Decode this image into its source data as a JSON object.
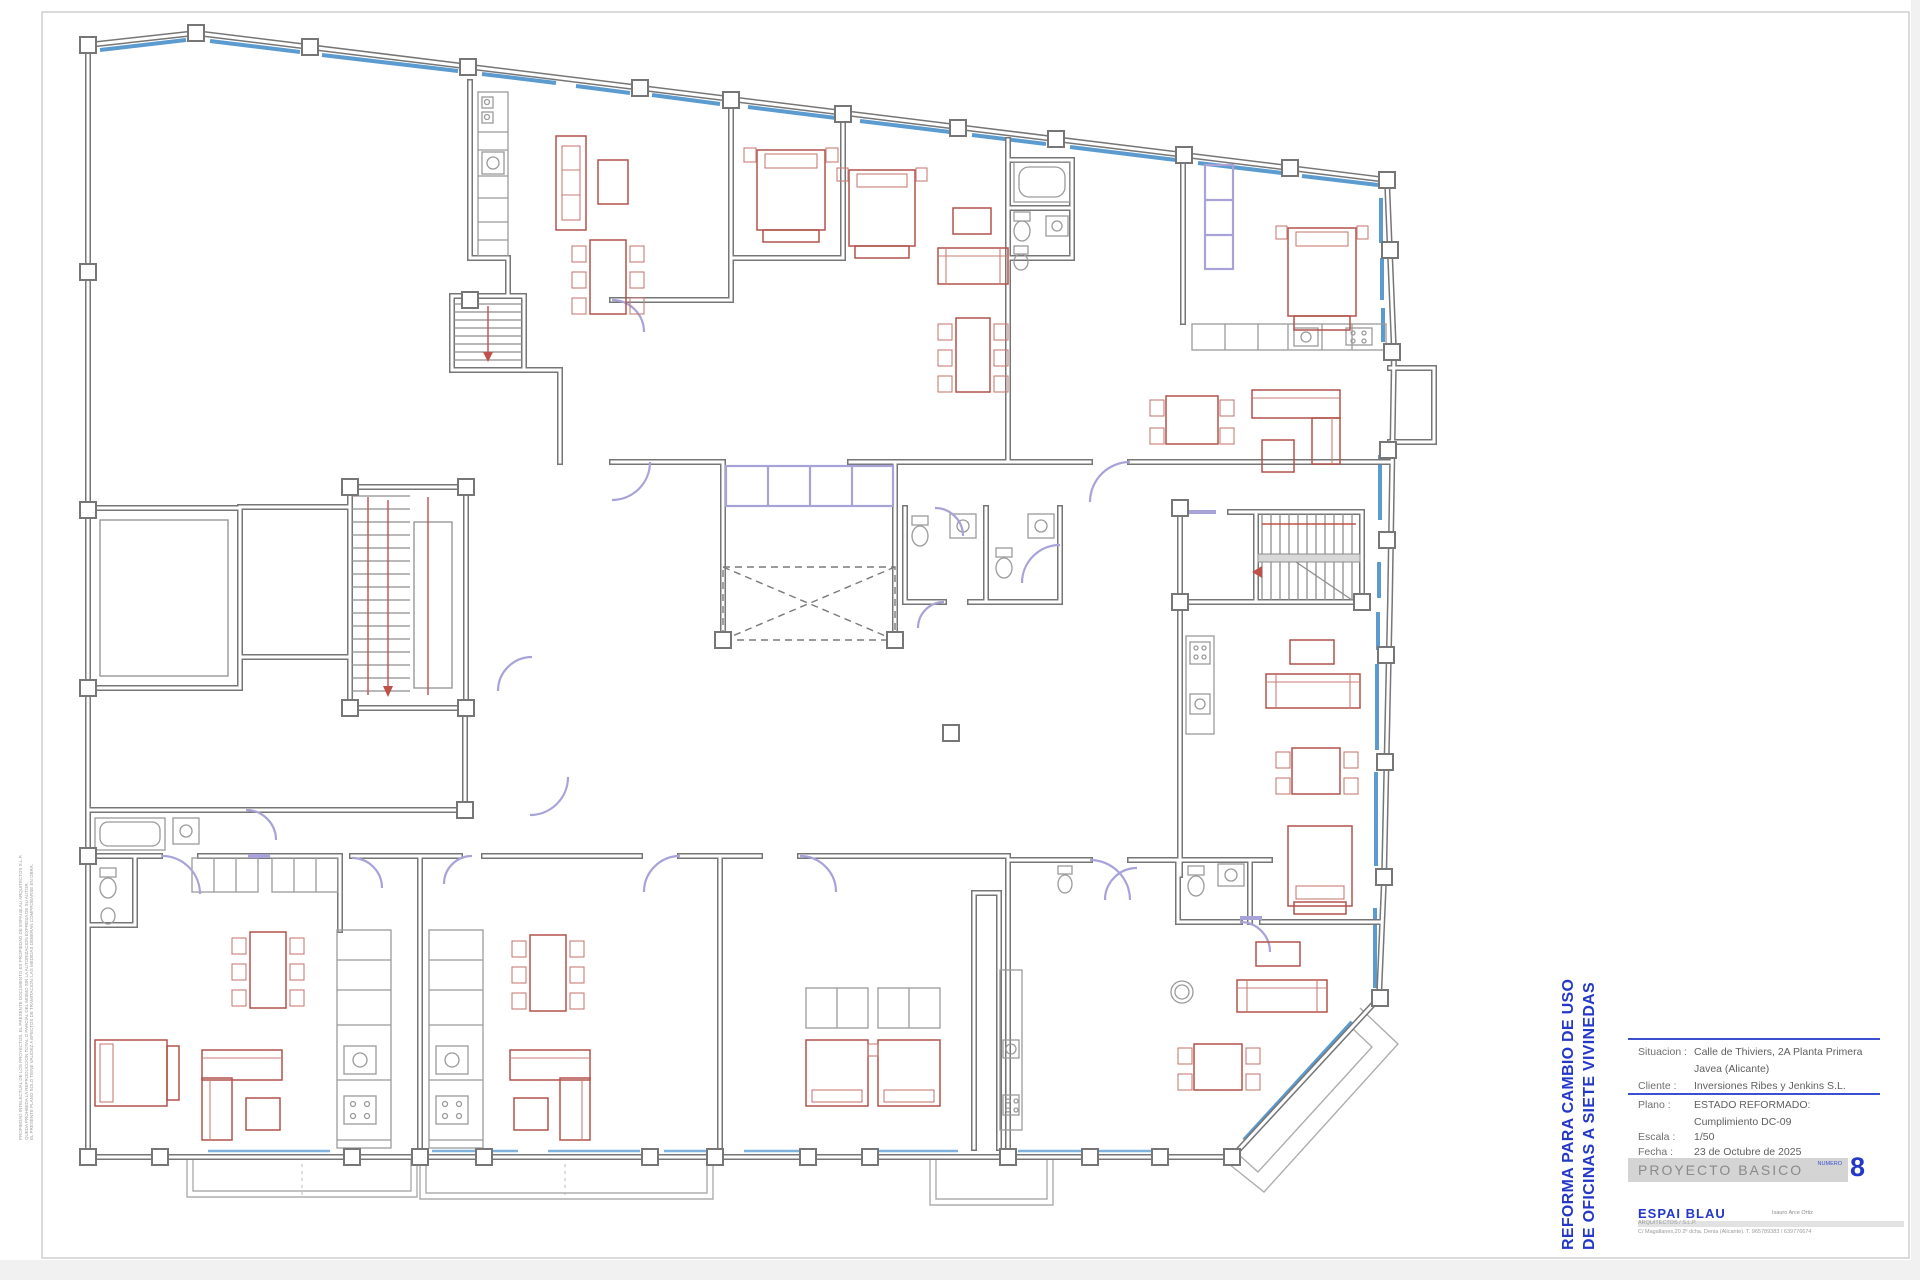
{
  "colors": {
    "wall_gray": "#767676",
    "window_blue": "#5b9bd0",
    "furniture_red": "#b3524b",
    "partition_purple": "#a7a3d9",
    "stair_marker_red": "#c0504a",
    "title_blue": "#2438c8",
    "bar_gray": "#d4d4d4"
  },
  "sidebar_legal": {
    "line1": "PROPIEDAD INTELECTUAL DE LOS PROYECTOS. EL PRESENTE DOCUMENTO ES PROPIEDAD DE ESPAI BLAU ARQUITECTOS S.L.P.",
    "line2": "QUEDA PROHIBIDA LA REPRODUCCION TOTAL O PARCIAL DEL MISMO SIN LA AUTORIZACION EXPRESA DE SU AUTOR.",
    "line3": "EL PRESENTE PLANO SOLO TIENE VALIDEZ A EFECTOS DE TRAMITACION. LAS MEDIDAS DEBERAN COMPROBARSE EN OBRA."
  },
  "title_block": {
    "project_title_line1": "REFORMA PARA CAMBIO DE USO",
    "project_title_line2": "DE OFICINAS A SIETE VIVINEDAS",
    "situacion_label": "Situacion :",
    "situacion_value": "Calle de Thiviers, 2A Planta Primera",
    "situacion_value2": "Javea (Alicante)",
    "cliente_label": "Cliente :",
    "cliente_value": "Inversiones Ribes y Jenkins S.L.",
    "plano_label": "Plano :",
    "plano_value": "ESTADO REFORMADO:",
    "plano_value2": "Cumplimiento DC-09",
    "escala_label": "Escala :",
    "escala_value": "1/50",
    "fecha_label": "Fecha :",
    "fecha_value": "23 de Octubre de 2025",
    "stage_label": "PROYECTO   BASICO",
    "numero_label": "NUMERO",
    "sheet_number": "8",
    "firm_name": "ESPAI  BLAU",
    "firm_sub": "ARQUITECTOS / S.L.P.",
    "architect_name": "Isauro Arce Ortiz",
    "firm_address": "C/ Magallanes,20 2º dcha. Denia (Alicante). T. 965789383 / 639776674"
  }
}
